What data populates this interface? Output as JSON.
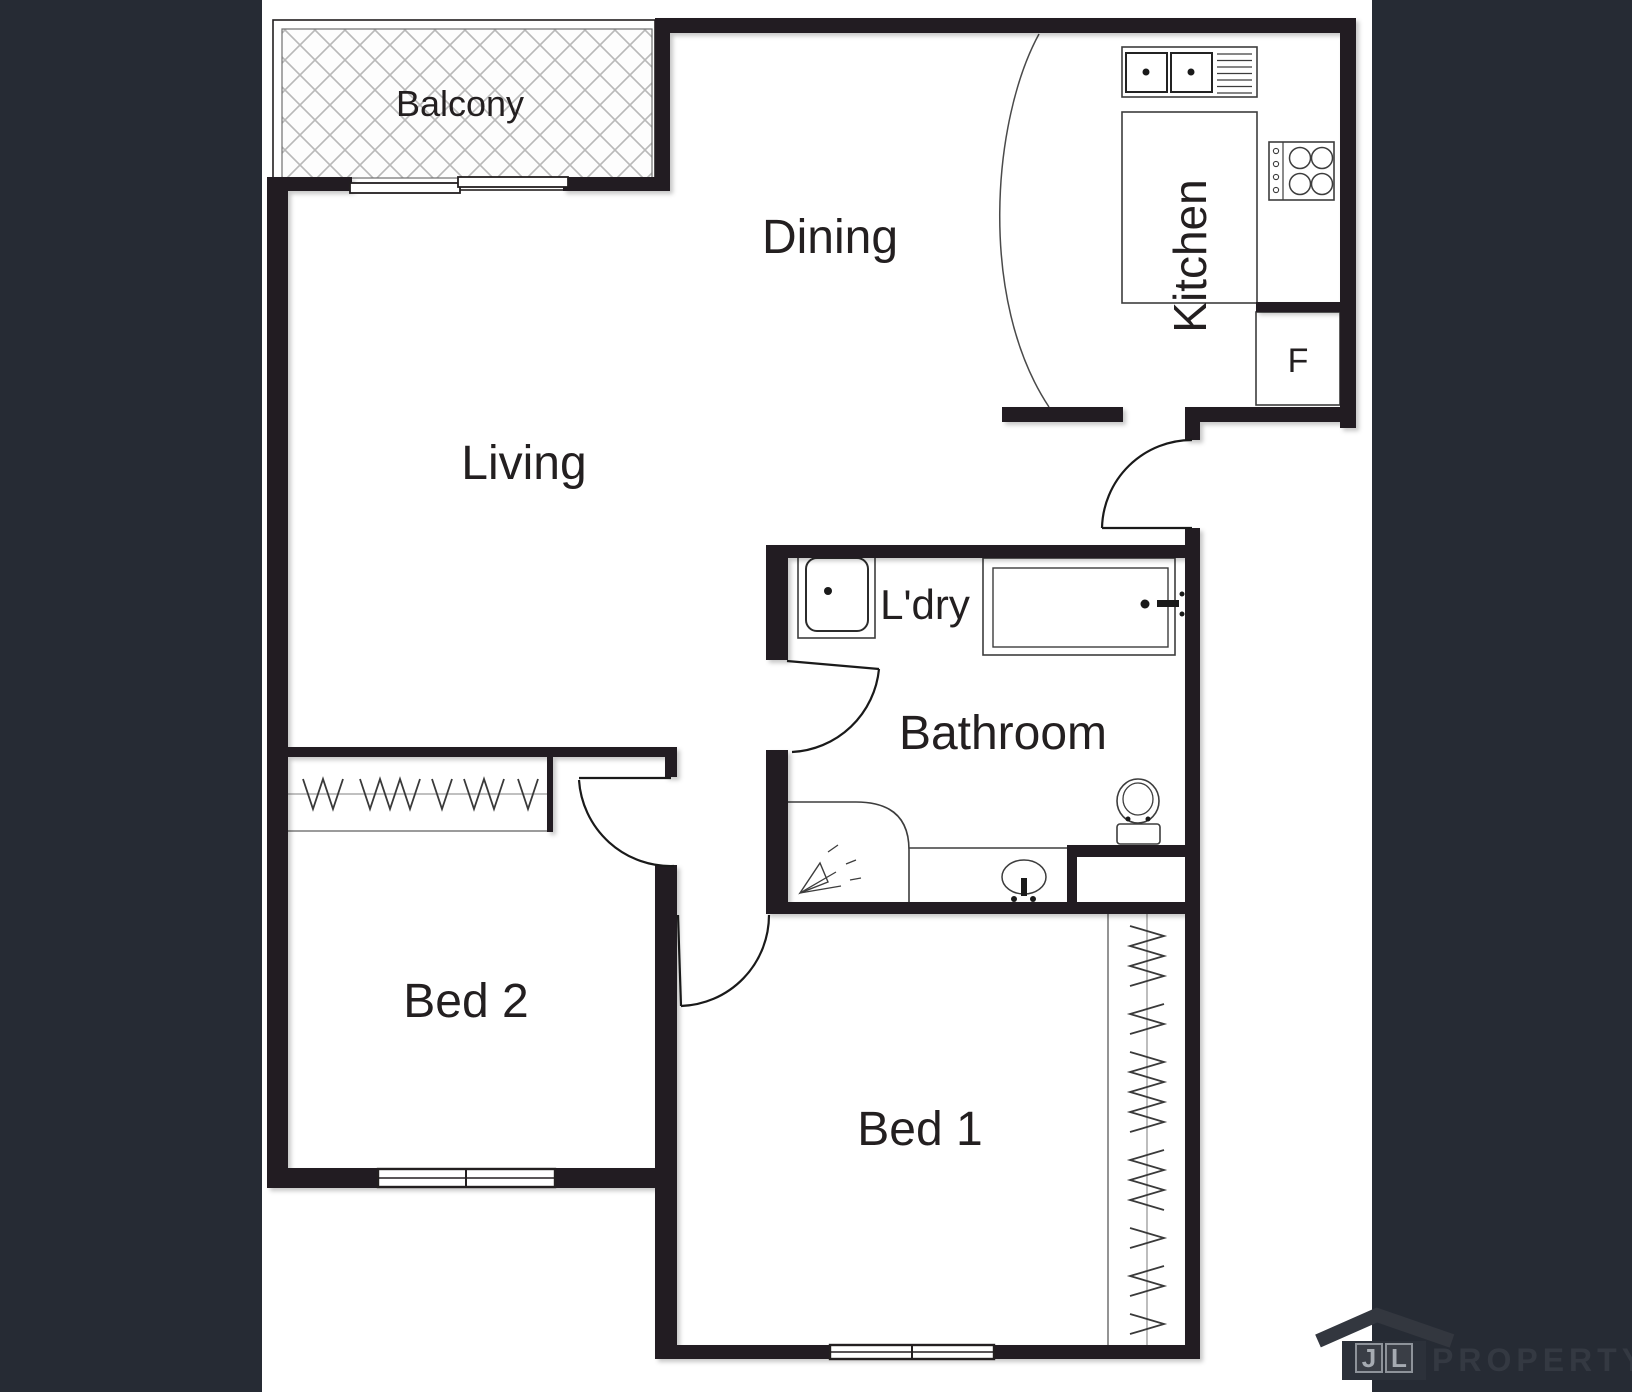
{
  "colors": {
    "background": "#262b34",
    "plan_background": "#ffffff",
    "wall": "#231f20",
    "label": "#231f20",
    "hatch_line": "#b9b9b9",
    "logo_roof": "#33373f",
    "logo_body": "#2c313a",
    "logo_text": "#343942",
    "logo_letter": "#a6abb2"
  },
  "rooms": {
    "balcony": {
      "label": "Balcony"
    },
    "dining": {
      "label": "Dining"
    },
    "kitchen": {
      "label": "Kitchen"
    },
    "living": {
      "label": "Living"
    },
    "laundry": {
      "label": "L'dry"
    },
    "bathroom": {
      "label": "Bathroom"
    },
    "bed2": {
      "label": "Bed 2"
    },
    "bed1": {
      "label": "Bed 1"
    }
  },
  "fixtures": {
    "fridge_label": "F"
  },
  "icons": {
    "kitchen_sink": "double-sink-with-drainer",
    "cooktop": "four-burner-stove",
    "fridge": "fridge-box",
    "bathtub": "bathtub-with-tap",
    "toilet": "toilet",
    "basin": "vanity-basin",
    "shower": "shower-spray",
    "laundry_trough": "laundry-trough",
    "wardrobe": "zigzag-hanging-rail",
    "logo_house": "house-roof"
  },
  "logo": {
    "letter_j": "J",
    "letter_l": "L",
    "brand": "PROPERTY"
  }
}
